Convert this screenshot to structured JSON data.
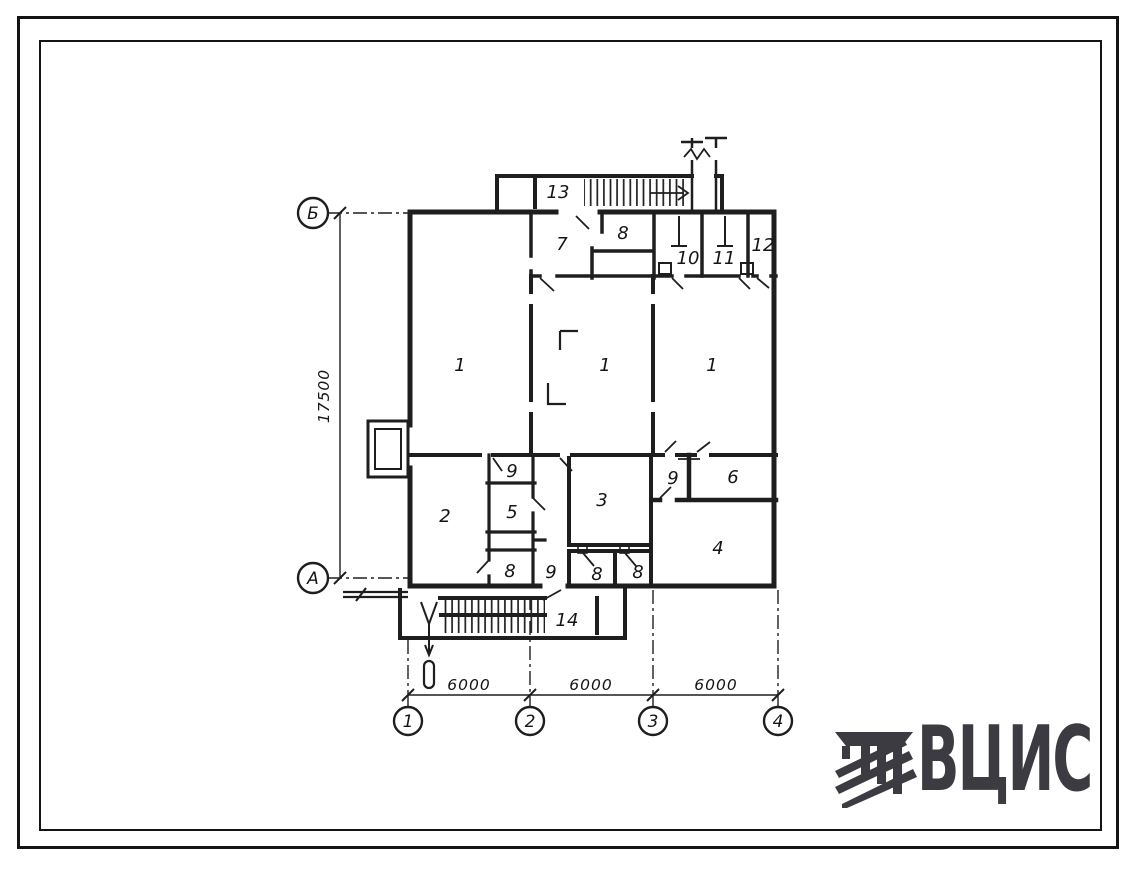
{
  "colors": {
    "ink": "#1e1e1e",
    "logo": "#3c3b41",
    "paper": "#ffffff"
  },
  "logo": {
    "text": "ВЦИС"
  },
  "plan": {
    "room_labels": [
      {
        "text": "13",
        "x": 558,
        "y": 198
      },
      {
        "text": "7",
        "x": 562,
        "y": 250
      },
      {
        "text": "8",
        "x": 623,
        "y": 239
      },
      {
        "text": "10",
        "x": 688,
        "y": 264
      },
      {
        "text": "11",
        "x": 724,
        "y": 264
      },
      {
        "text": "12",
        "x": 763,
        "y": 251
      },
      {
        "text": "1",
        "x": 460,
        "y": 371
      },
      {
        "text": "1",
        "x": 605,
        "y": 371
      },
      {
        "text": "1",
        "x": 712,
        "y": 371
      },
      {
        "text": "9",
        "x": 512,
        "y": 477
      },
      {
        "text": "5",
        "x": 512,
        "y": 518
      },
      {
        "text": "2",
        "x": 445,
        "y": 522
      },
      {
        "text": "3",
        "x": 602,
        "y": 506
      },
      {
        "text": "9",
        "x": 673,
        "y": 484
      },
      {
        "text": "6",
        "x": 733,
        "y": 483
      },
      {
        "text": "4",
        "x": 718,
        "y": 554
      },
      {
        "text": "8",
        "x": 510,
        "y": 577
      },
      {
        "text": "9",
        "x": 551,
        "y": 578
      },
      {
        "text": "8",
        "x": 597,
        "y": 580
      },
      {
        "text": "8",
        "x": 638,
        "y": 578
      },
      {
        "text": "14",
        "x": 567,
        "y": 626
      }
    ],
    "axis_bubbles": [
      {
        "label": "Б",
        "x": 313,
        "y": 213,
        "r": 15
      },
      {
        "label": "А",
        "x": 313,
        "y": 578,
        "r": 15
      },
      {
        "label": "1",
        "x": 408,
        "y": 721,
        "r": 14
      },
      {
        "label": "2",
        "x": 530,
        "y": 721,
        "r": 14
      },
      {
        "label": "3",
        "x": 653,
        "y": 721,
        "r": 14
      },
      {
        "label": "4",
        "x": 778,
        "y": 721,
        "r": 14
      }
    ],
    "dim_labels": [
      {
        "text": "17500",
        "x": 329,
        "y": 396,
        "rot": -90
      },
      {
        "text": "6000",
        "x": 469,
        "y": 690,
        "rot": 0
      },
      {
        "text": "6000",
        "x": 591,
        "y": 690,
        "rot": 0
      },
      {
        "text": "6000",
        "x": 716,
        "y": 690,
        "rot": 0
      }
    ]
  }
}
